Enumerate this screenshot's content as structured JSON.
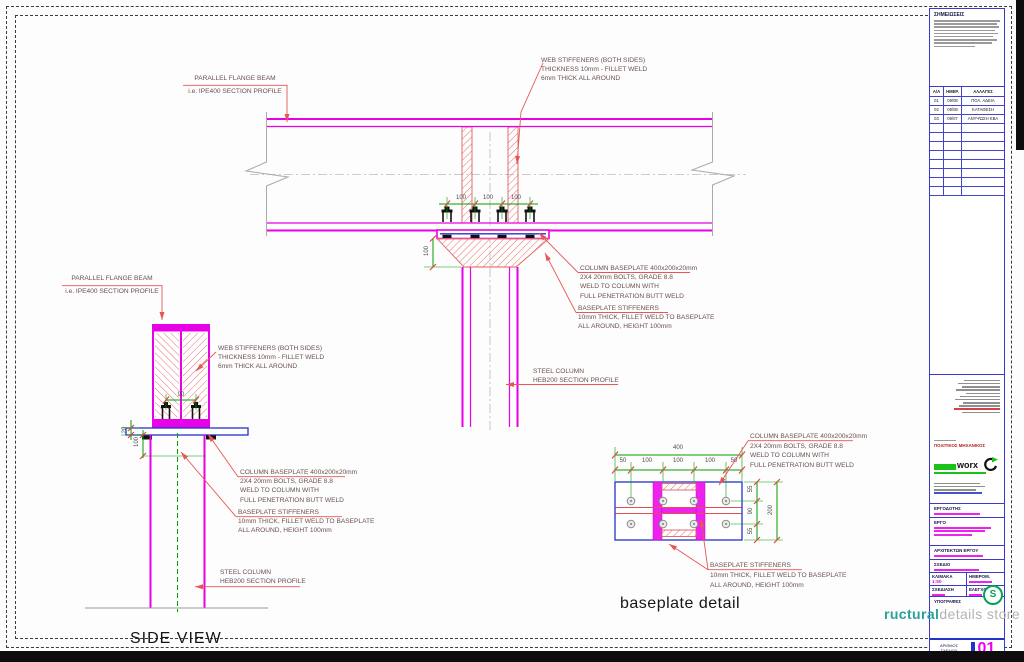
{
  "labels": {
    "beam": [
      "PARALLEL FLANGE BEAM",
      "i.e. IPE400 SECTION PROFILE"
    ],
    "web_stiffeners": [
      "WEB STIFFENERS (BOTH SIDES)",
      "THICKNESS 10mm - FILLET WELD",
      "6mm THICK ALL AROUND"
    ],
    "column_baseplate": [
      "COLUMN BASEPLATE 400x200x20mm",
      "2X4 20mm BOLTS, GRADE 8.8",
      "WELD TO COLUMN WITH",
      "FULL PENETRATION BUTT WELD"
    ],
    "baseplate_stiffeners": [
      "BASEPLATE STIFFENERS",
      "10mm THICK, FILLET WELD TO BASEPLATE",
      "ALL AROUND, HEIGHT 100mm"
    ],
    "steel_column": [
      "STEEL COLUMN",
      "HEB200 SECTION PROFILE"
    ]
  },
  "titles": {
    "side_view": "SIDE VIEW",
    "baseplate_detail": "baseplate detail"
  },
  "dims": {
    "front": {
      "bolt_spacing": [
        "100",
        "100",
        "100"
      ],
      "stiffener_height": "100"
    },
    "side": {
      "plate_thickness": "20",
      "height": "100",
      "bolt_gauge": "90"
    },
    "plan": {
      "overall_width": "400",
      "width_segments": [
        "50",
        "100",
        "100",
        "100",
        "50"
      ],
      "height_segments": [
        "55",
        "90",
        "55"
      ],
      "overall_height": "200"
    }
  },
  "titleblock": {
    "notes_title": "ΣΗΜΕΙΩΣΕΙΣ",
    "revisions": {
      "headers": [
        "Α/Α",
        "ΗΜΕΡ.",
        "ΑΛΛΑΓΕΣ"
      ],
      "rows": [
        [
          "01",
          "09/08",
          "ΠΟΛ. ΑΔΕΙΑ"
        ],
        [
          "02",
          "09/08",
          "ΚΑΤΑΘΕΣΗ"
        ],
        [
          "03",
          "09/07",
          "ΑΝΥΨΩΣΗ ΚΒΑ"
        ]
      ]
    },
    "engineer_role": "ΠΟΛΙΤΙΚΟΣ ΜΗΧΑΝΙΚΟΣ",
    "logo_text": "worx",
    "fields": {
      "client": "ΕΡΓΟΔΟΤΗΣ",
      "project": "ΕΡΓΟ",
      "architect": "ΑΡΧΙΤΕΚΤΩΝ ΕΡΓΟΥ",
      "drawing": "ΣΧΕΔΙΟ",
      "scale": "ΚΛΙΜΑΚΑ",
      "date": "ΗΜΕΡΟΜ.",
      "drafted": "ΣΧΕΔΙΑΣΗ",
      "checked": "ΕΛΕΓΧΟΣ",
      "signatures": "ΥΠΟΓΡΑΦΕΣ"
    },
    "scale_value": "1:50",
    "number_label": [
      "ΑΡΙΘΜΟΣ",
      "ΣΧΕΔΙΟΥ"
    ],
    "number": "01",
    "brand": {
      "logo_letter": "S",
      "name_bold": "ructural",
      "name_light": "details store"
    }
  },
  "colors": {
    "magenta": "#ee00ee",
    "dimension_green": "#00a000",
    "leader_red": "#e85555",
    "plate_blue": "#2233cc",
    "brand_teal": "#2aa198",
    "logo_green": "#19c119"
  }
}
